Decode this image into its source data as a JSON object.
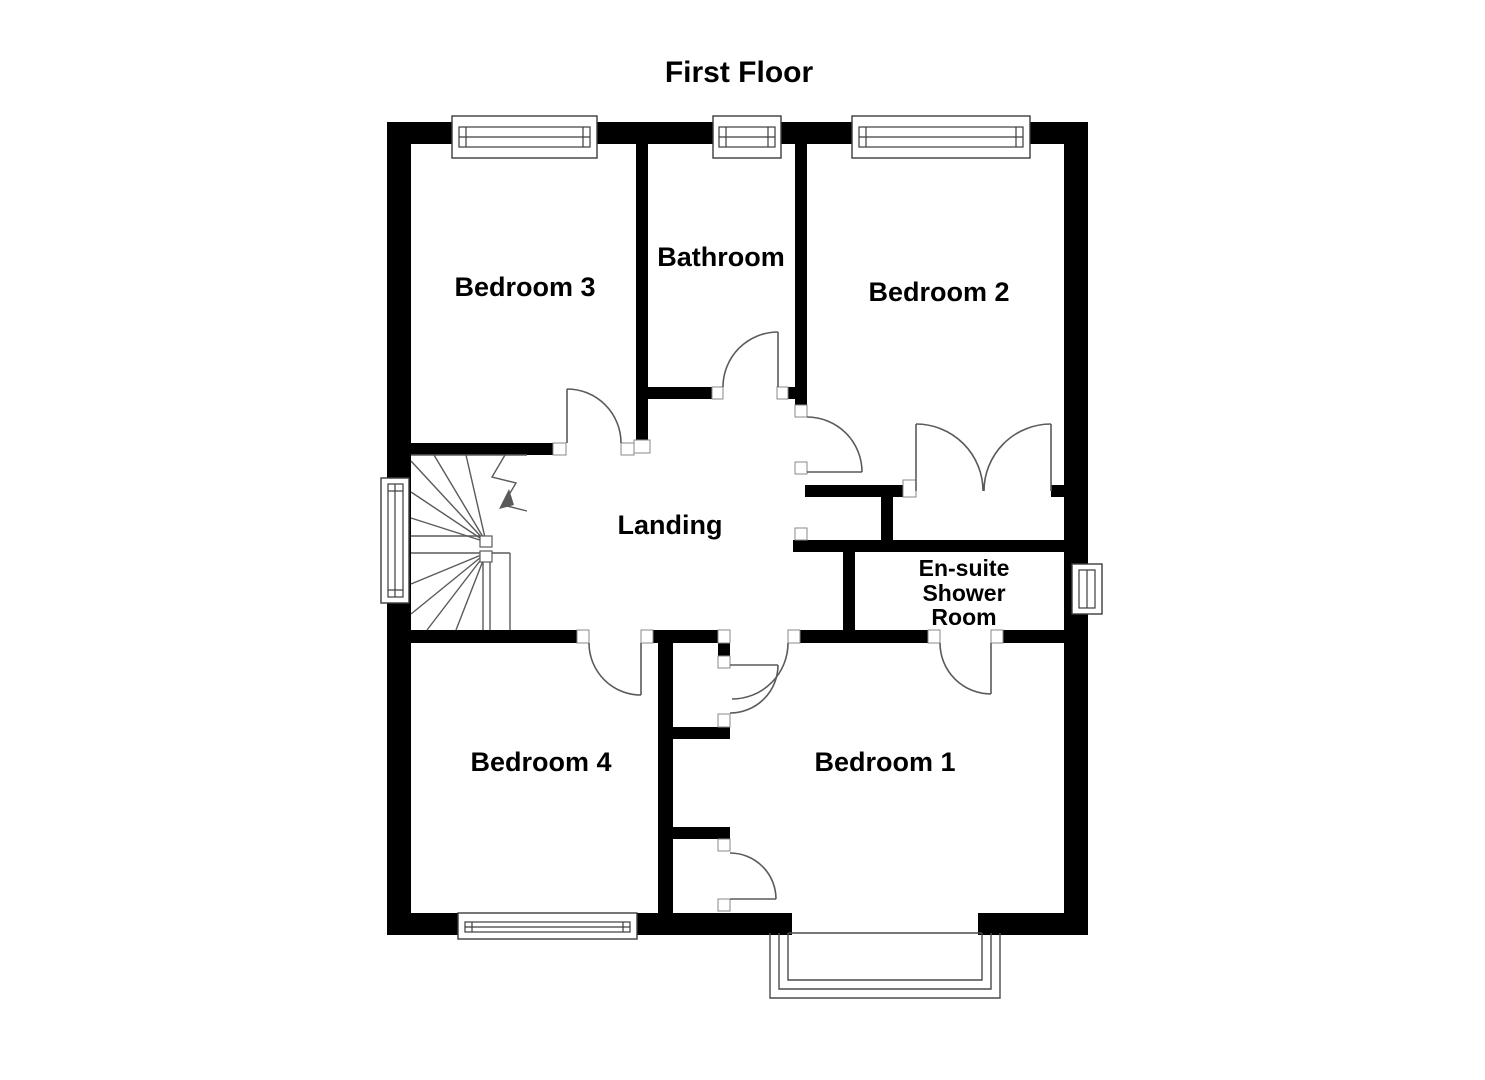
{
  "plan": {
    "title": "First Floor",
    "rooms": [
      {
        "id": "bedroom3",
        "label": "Bedroom 3"
      },
      {
        "id": "bathroom",
        "label": "Bathroom"
      },
      {
        "id": "bedroom2",
        "label": "Bedroom 2"
      },
      {
        "id": "landing",
        "label": "Landing"
      },
      {
        "id": "ensuite",
        "label": "En-suite Shower Room",
        "lines": [
          "En-suite",
          "Shower",
          "Room"
        ]
      },
      {
        "id": "bedroom4",
        "label": "Bedroom 4"
      },
      {
        "id": "bedroom1",
        "label": "Bedroom 1"
      }
    ],
    "features": {
      "staircase": "winder staircase",
      "bay_window": "bay window at Bedroom 1",
      "wardrobe": "double-door wardrobe in Bedroom 2",
      "cupboards": "two cupboards in Bedroom 1"
    },
    "colors": {
      "wall": "#000000",
      "background": "#ffffff",
      "thin_line": "#5a5a5a"
    }
  }
}
